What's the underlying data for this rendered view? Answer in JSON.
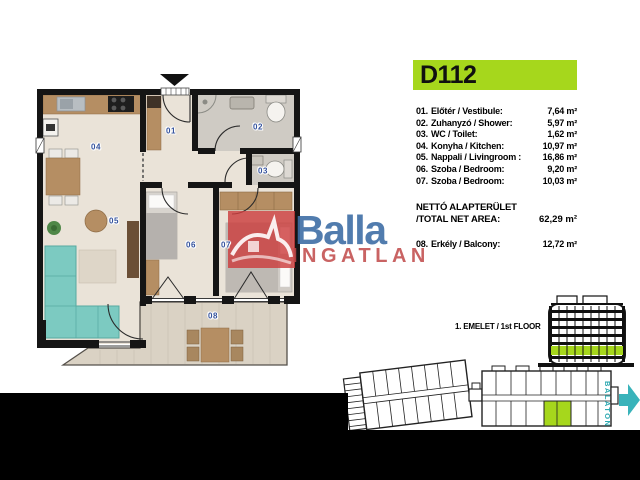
{
  "title": {
    "unit_code": "D112"
  },
  "room_list": [
    {
      "num": "01.",
      "name": "Előtér / Vestibule:",
      "area": "7,64 m²"
    },
    {
      "num": "02.",
      "name": "Zuhanyzó / Shower:",
      "area": "5,97 m²"
    },
    {
      "num": "03.",
      "name": "WC / Toilet:",
      "area": "1,62 m²"
    },
    {
      "num": "04.",
      "name": "Konyha / Kitchen:",
      "area": "10,97 m²"
    },
    {
      "num": "05.",
      "name": "Nappali / Livingroom :",
      "area": "16,86 m²"
    },
    {
      "num": "06.",
      "name": "Szoba / Bedroom:",
      "area": "9,20 m²"
    },
    {
      "num": "07.",
      "name": "Szoba / Bedroom:",
      "area": "10,03 m²"
    }
  ],
  "net_area": {
    "label_hu": "NETTÓ ALAPTERÜLET",
    "label_en": "/TOTAL NET AREA:",
    "value": "62,29 m²"
  },
  "balcony_row": {
    "num": "08.",
    "name": "Erkély / Balcony:",
    "area": "12,72 m²"
  },
  "floor_indicator": "1. EMELET / 1st FLOOR",
  "direction_arrow_label": "BALATON",
  "watermark": {
    "brand": "Balla",
    "subtitle": "INGATLAN"
  },
  "plan_room_labels": {
    "r01": "01",
    "r02": "02",
    "r03": "03",
    "r04": "04",
    "r05": "05",
    "r06": "06",
    "r07": "07",
    "r08": "08"
  },
  "colors": {
    "highlight_green": "#a6d71c",
    "balaton_teal": "#39b3ba",
    "brand_blue": "#3e6ea5",
    "brand_red": "#c04848",
    "wall_black": "#151515",
    "sofa_teal": "#7ccac1"
  }
}
